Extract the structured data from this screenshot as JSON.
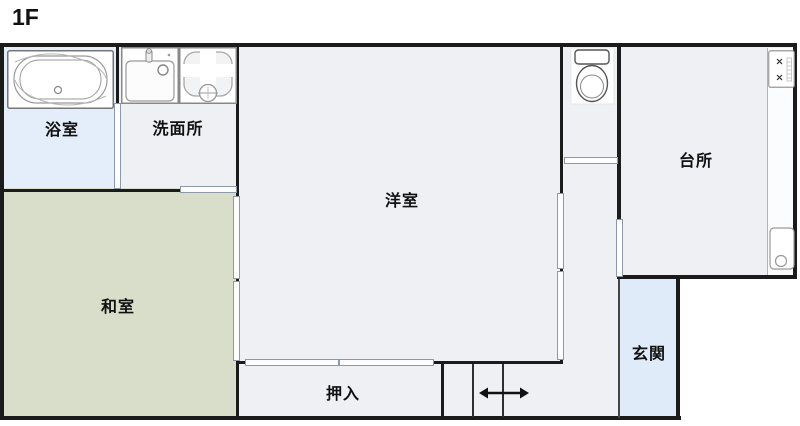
{
  "floor_title": "1F",
  "rooms": [
    {
      "name": "bathroom",
      "label": "浴室"
    },
    {
      "name": "washroom",
      "label": "洗面所"
    },
    {
      "name": "western-room",
      "label": "洋室"
    },
    {
      "name": "kitchen",
      "label": "台所"
    },
    {
      "name": "japanese-room",
      "label": "和室"
    },
    {
      "name": "closet",
      "label": "押入"
    },
    {
      "name": "entrance",
      "label": "玄関"
    }
  ],
  "fixtures": [
    "bathtub-icon",
    "vanity-sink-icon",
    "washing-machine-pan-icon",
    "toilet-icon",
    "gas-stove-icon",
    "kitchen-sink-icon",
    "staircase-direction-arrow-icon"
  ],
  "colors": {
    "wall": "#1b1b1b",
    "floor_gray": "#eef0f3",
    "tatami_green": "#d9decb",
    "bath_blue": "#e4eefa",
    "entrance_blue": "#dfebf8",
    "page_background": "#ffffff"
  }
}
